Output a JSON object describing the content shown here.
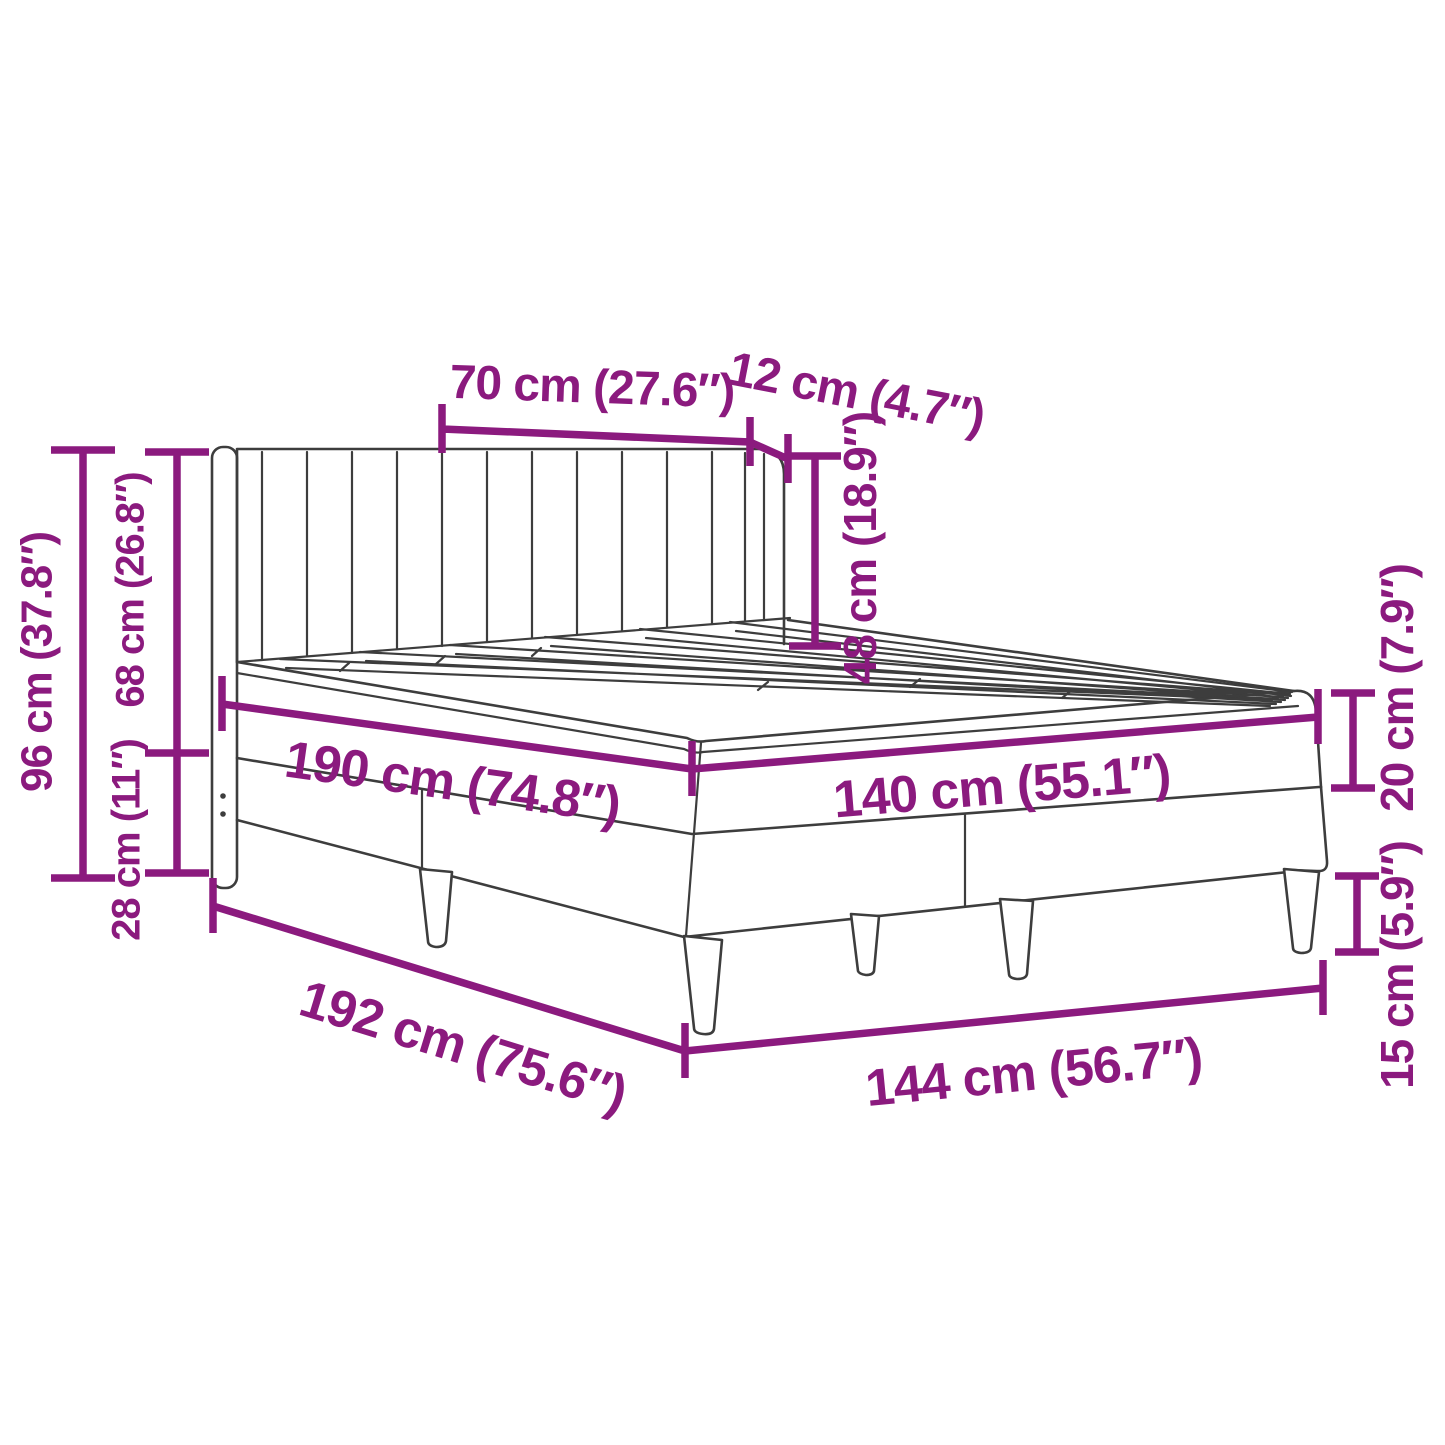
{
  "page": {
    "background": "#ffffff"
  },
  "diagram": {
    "type": "product-dimension-diagram",
    "subject": "upholstered bed frame with winged headboard, slatted platform and tapered legs",
    "accent_color": "#8B1A7E",
    "outline_color": "#3d3d3d",
    "unit_system": "cm (inches)",
    "dimensions": {
      "headboard_cushion_width": "70 cm (27.6″)",
      "headboard_wing_width": "12 cm (4.7″)",
      "headboard_above_platform": "48 cm (18.9″)",
      "headboard_total_height": "96 cm (37.8″)",
      "headboard_upper_height": "68 cm (26.8″)",
      "headboard_lower_height": "28 cm (11″)",
      "platform_length": "190 cm (74.8″)",
      "platform_width": "140 cm (55.1″)",
      "frame_length": "192 cm (75.6″)",
      "frame_width": "144 cm (56.7″)",
      "base_top_height": "20 cm (7.9″)",
      "leg_height": "15 cm (5.9″)"
    }
  }
}
